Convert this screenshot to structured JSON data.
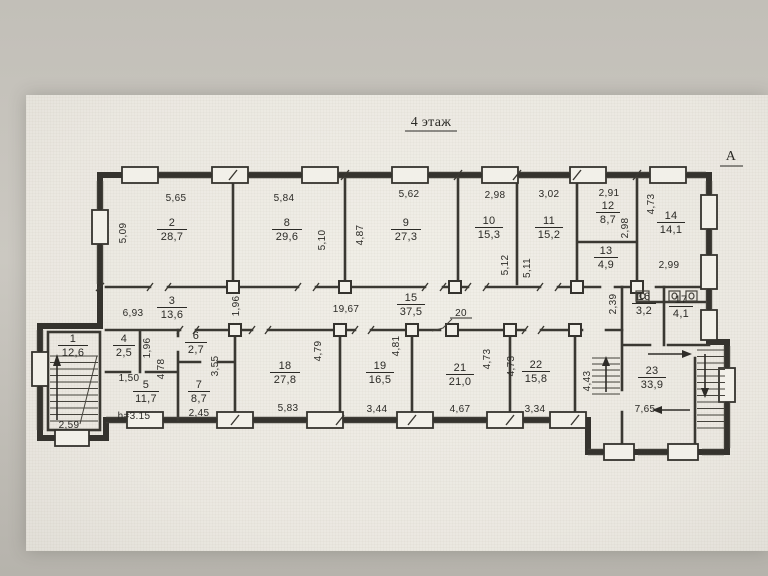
{
  "title": "4 этаж",
  "section_marker": "А",
  "rooms": [
    {
      "number": "1",
      "area": "12,6"
    },
    {
      "number": "2",
      "area": "28,7"
    },
    {
      "number": "3",
      "area": "13,6"
    },
    {
      "number": "4",
      "area": "2,5"
    },
    {
      "number": "5",
      "area": "11,7"
    },
    {
      "number": "6",
      "area": "2,7"
    },
    {
      "number": "7",
      "area": "8,7"
    },
    {
      "number": "8",
      "area": "29,6"
    },
    {
      "number": "9",
      "area": "27,3"
    },
    {
      "number": "10",
      "area": "15,3"
    },
    {
      "number": "11",
      "area": "15,2"
    },
    {
      "number": "12",
      "area": "8,7"
    },
    {
      "number": "13",
      "area": "4,9"
    },
    {
      "number": "14",
      "area": "14,1"
    },
    {
      "number": "15",
      "area": "37,5"
    },
    {
      "number": "16",
      "area": "3,2"
    },
    {
      "number": "17",
      "area": "4,1"
    },
    {
      "number": "18",
      "area": "27,8"
    },
    {
      "number": "19",
      "area": "16,5"
    },
    {
      "number": "21",
      "area": "21,0"
    },
    {
      "number": "22",
      "area": "15,8"
    },
    {
      "number": "23",
      "area": "33,9"
    }
  ],
  "dims": {
    "room2_width": "5,65",
    "room8_width": "5,84",
    "room9_width": "5,62",
    "room10_width": "2,98",
    "room11_width": "3,02",
    "room12_width": "2,91",
    "room2_depth": "5,09",
    "room8_depth": "5,10",
    "room9_depth": "4,87",
    "room10_depth": "5,12",
    "room11_depth": "5,11",
    "room12_depth": "2,98",
    "room14_depth": "4,73",
    "room14_width": "2,99",
    "corridor_left": "6,93",
    "corridor_niche": "1,96",
    "corridor_length": "19,67",
    "corridor_right": "2,39",
    "room4_depth": "1,96",
    "hall_depth": "4,78",
    "room7_depth": "3,55",
    "room5_width": "1,50",
    "room7_width": "2,45",
    "room18_width": "5,83",
    "room18_depth": "4,79",
    "room19_width": "3,44",
    "room19_depth": "4,81",
    "room21_width": "4,67",
    "room21_depth": "4,73",
    "room22_width": "3,34",
    "room22_depth": "4,73",
    "room23_width": "7,65",
    "room23_depth": "4,43",
    "stair1_width": "2,59"
  },
  "notes": {
    "ceiling_height": "h=3.15",
    "door_label": "20"
  }
}
